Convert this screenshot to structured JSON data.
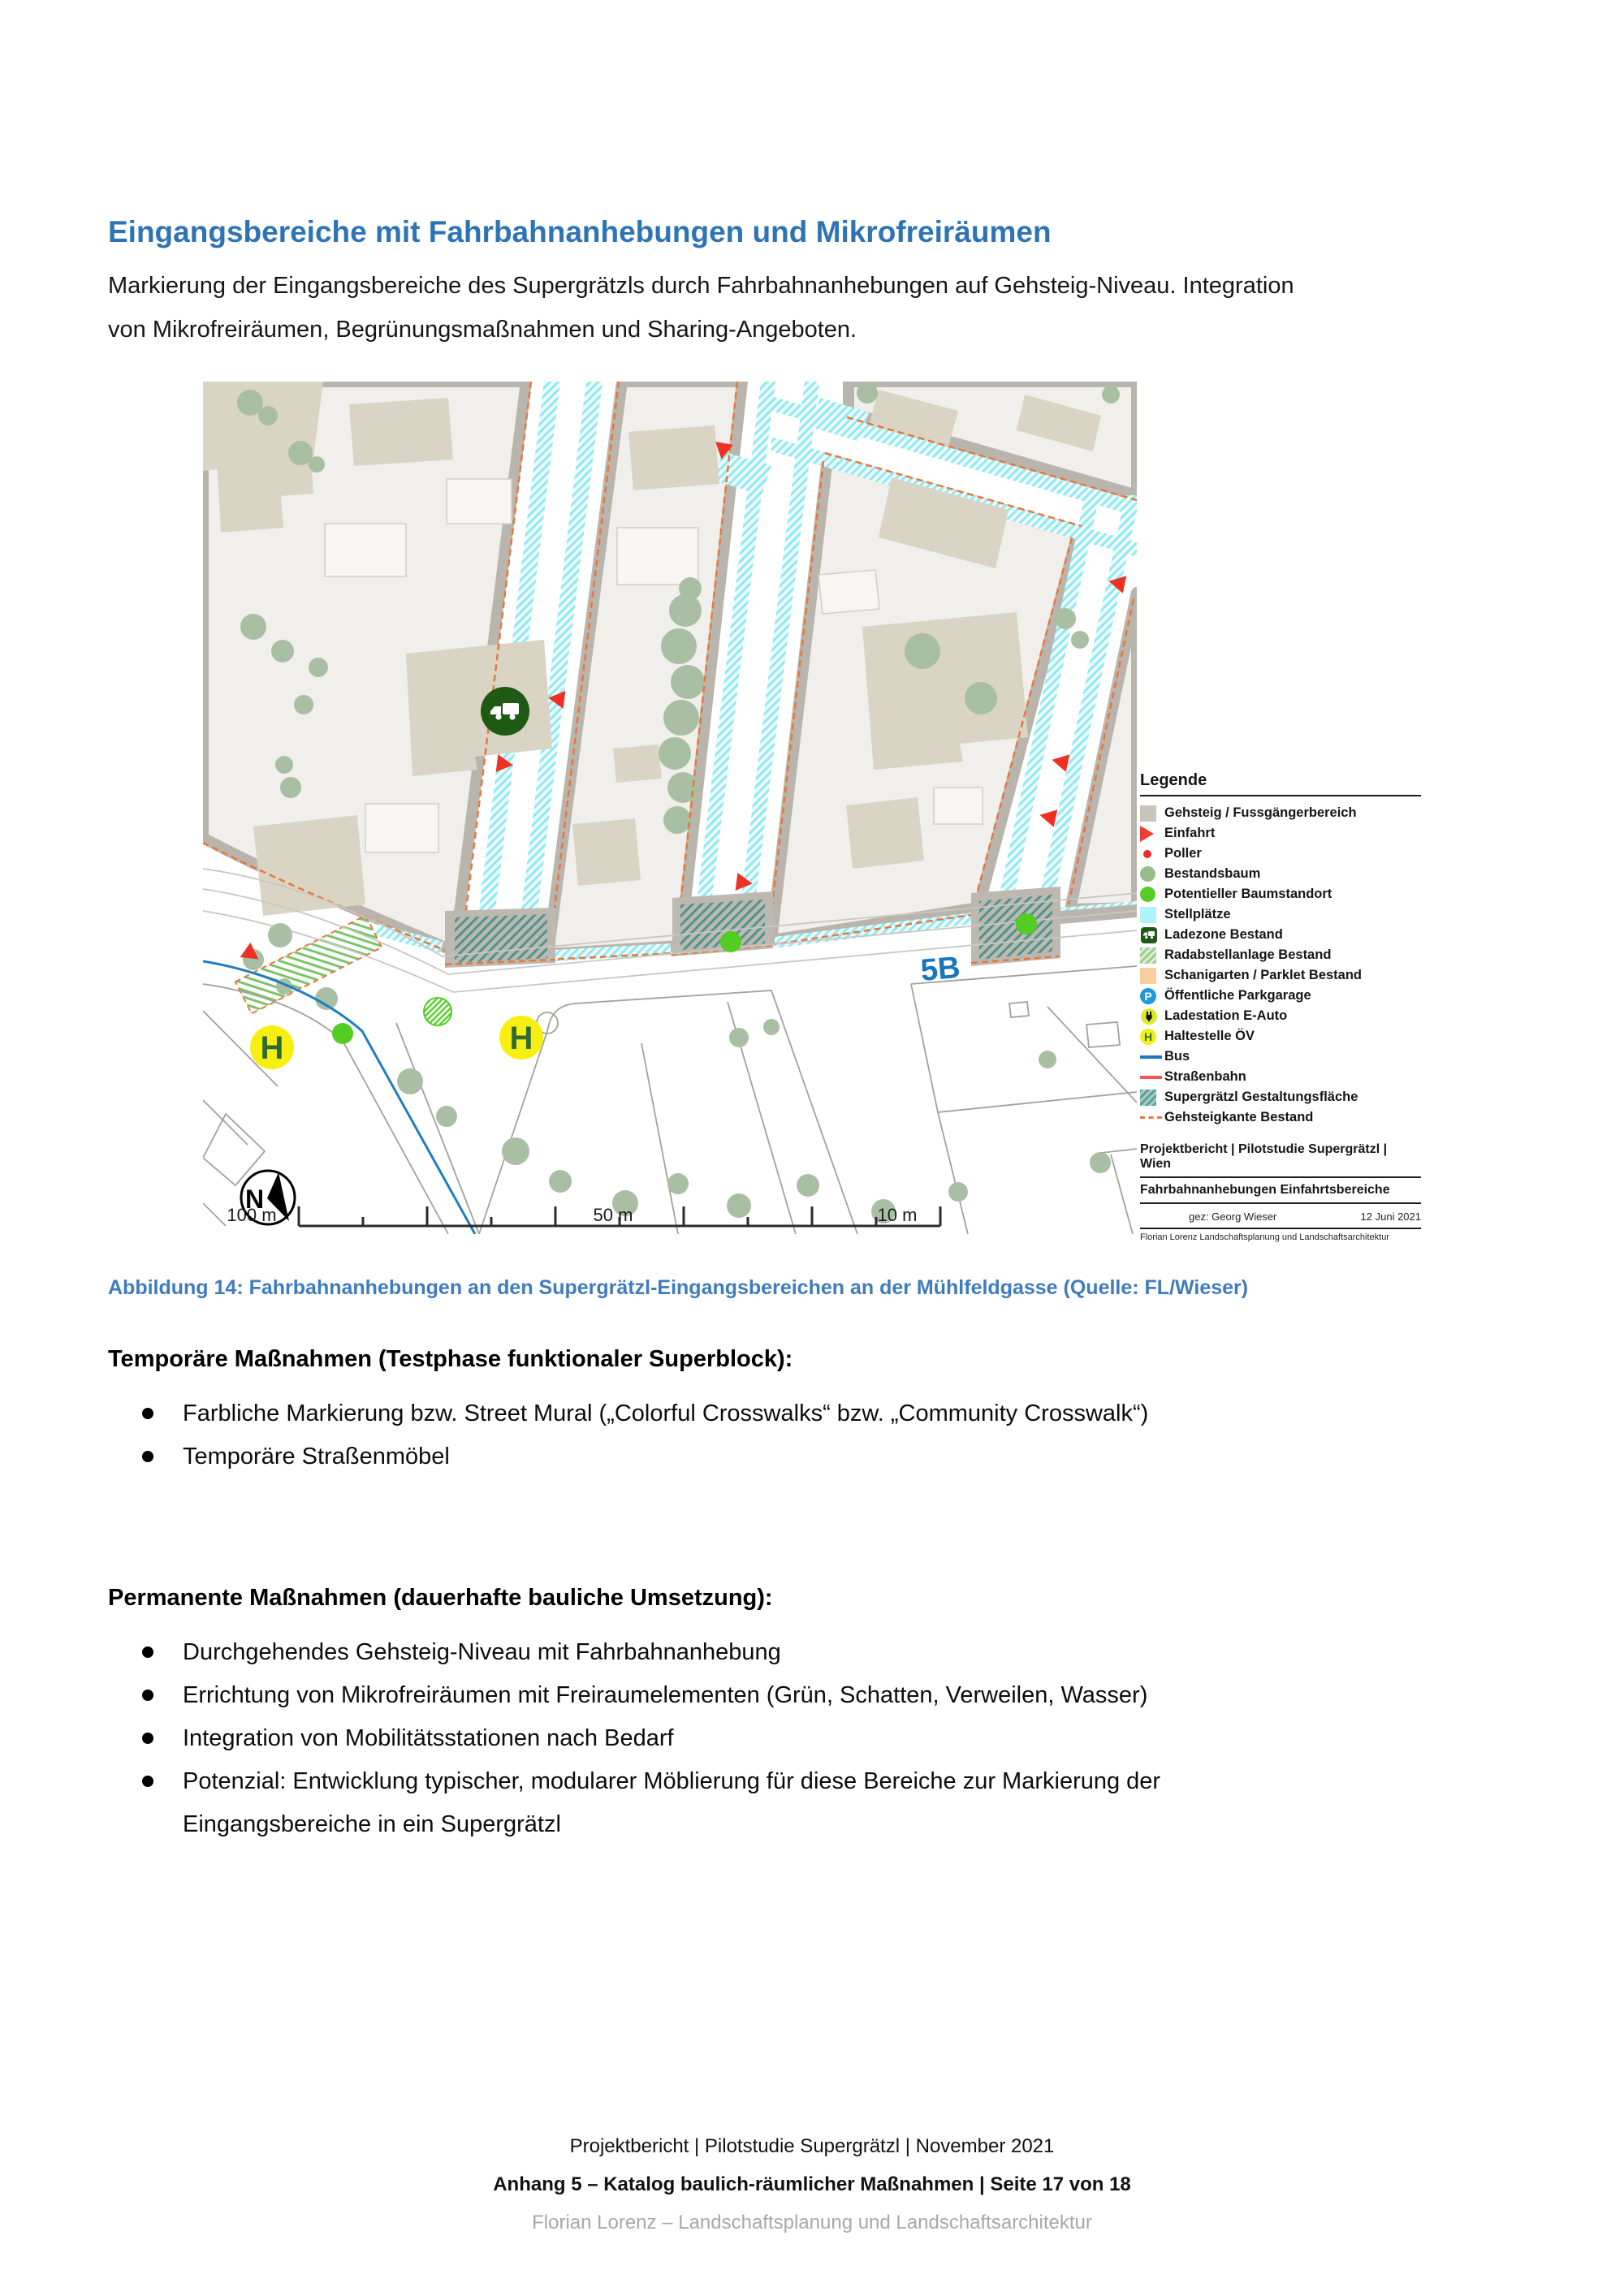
{
  "page": {
    "title": "Eingangsbereiche mit Fahrbahnanhebungen und Mikrofreiräumen",
    "subtitle": "Markierung der Eingangsbereiche des Supergrätzls durch Fahrbahnanhebungen auf Gehsteig-Niveau. Integration von Mikrofreiräumen, Begrünungsmaßnahmen und Sharing-Angeboten.",
    "caption": "Abbildung 14: Fahrbahnanhebungen an den Supergrätzl-Eingangsbereichen an der Mühlfeldgasse (Quelle: FL/Wieser)"
  },
  "sections": [
    {
      "heading": "Temporäre Maßnahmen (Testphase funktionaler Superblock):",
      "bullets": [
        "Farbliche Markierung bzw. Street Mural („Colorful Crosswalks“ bzw. „Community Crosswalk“)",
        "Temporäre Straßenmöbel"
      ]
    },
    {
      "heading": "Permanente Maßnahmen (dauerhafte bauliche Umsetzung):",
      "bullets": [
        "Durchgehendes Gehsteig-Niveau mit Fahrbahnanhebung",
        "Errichtung von Mikrofreiräumen mit Freiraumelementen (Grün, Schatten, Verweilen, Wasser)",
        "Integration von Mobilitätsstationen nach Bedarf",
        "Potenzial: Entwicklung typischer, modularer Möblierung für diese Bereiche zur Markierung der Eingangsbereiche in ein Supergrätzl"
      ]
    }
  ],
  "map_labels": {
    "route": "5B",
    "stop": "H",
    "north": "N",
    "scale": [
      "100 m",
      "50 m",
      "10 m"
    ]
  },
  "legend": {
    "title": "Legende",
    "items": [
      {
        "name": "gehsteig",
        "icon": "square",
        "color": "#C9C5BD",
        "label": "Gehsteig / Fussgängerbereich"
      },
      {
        "name": "einfahrt",
        "icon": "triangle",
        "color": "#F23B30",
        "label": "Einfahrt"
      },
      {
        "name": "poller",
        "icon": "dot",
        "color": "#E23128",
        "label": "Poller"
      },
      {
        "name": "bestandsbaum",
        "icon": "circle",
        "color": "#96BE8C",
        "label": "Bestandsbaum"
      },
      {
        "name": "potentieller-baumstandort",
        "icon": "circle",
        "color": "#55CD26",
        "label": "Potentieller Baumstandort"
      },
      {
        "name": "stellplaetze",
        "icon": "square",
        "color": "#AFF3F8",
        "label": "Stellplätze"
      },
      {
        "name": "ladezone",
        "icon": "truck-badge",
        "color": "#1E5A14",
        "label": "Ladezone Bestand"
      },
      {
        "name": "radabstellanlage",
        "icon": "hatch-green",
        "color": "#9CCE90",
        "label": "Radabstellanlage Bestand"
      },
      {
        "name": "schanigarten",
        "icon": "square",
        "color": "#F8CFA0",
        "label": "Schanigarten / Parklet Bestand"
      },
      {
        "name": "parkgarage",
        "icon": "circle-letter",
        "color": "#1D9BD8",
        "letter": "P",
        "letter_color": "#FFFFFF",
        "label": "Öffentliche Parkgarage"
      },
      {
        "name": "ladestation-e-auto",
        "icon": "plug-badge",
        "color": "#DDE72B",
        "label": "Ladestation E-Auto"
      },
      {
        "name": "haltestelle-oev",
        "icon": "circle-letter",
        "color": "#F2EE19",
        "letter": "H",
        "letter_color": "#2E6B34",
        "label": "Haltestelle ÖV"
      },
      {
        "name": "bus",
        "icon": "line",
        "color": "#1C77C0",
        "label": "Bus"
      },
      {
        "name": "strassenbahn",
        "icon": "line",
        "color": "#F0555A",
        "label": "Straßenbahn"
      },
      {
        "name": "supergraetzl-flaeche",
        "icon": "hatch-teal",
        "color": "#5FA09A",
        "label": "Supergrätzl Gestaltungsfläche"
      },
      {
        "name": "gehsteigkante",
        "icon": "dash-line",
        "color": "#E8773B",
        "label": "Gehsteigkante Bestand"
      }
    ],
    "block": {
      "line1": "Projektbericht | Pilotstudie Supergrätzl | Wien",
      "line2": "Fahrbahnanhebungen Einfahrtsbereiche",
      "signed": "gez: Georg Wieser",
      "date": "12 Juni 2021",
      "firm": "Florian Lorenz Landschaftsplanung und Landschaftsarchitektur"
    }
  },
  "footer": {
    "line1": "Projektbericht | Pilotstudie Supergrätzl | November 2021",
    "line2": "Anhang 5 – Katalog baulich-räumlicher Maßnahmen | Seite 17 von 18",
    "line3": "Florian Lorenz – Landschaftsplanung und Landschaftsarchitektur"
  },
  "colors": {
    "accent_heading": "#2E74B5",
    "caption_blue": "#3E7CBE",
    "route_blue": "#1B75BC",
    "entry_red": "#EE3124",
    "stop_yellow": "#F8EF12",
    "loading_green": "#1E5A14",
    "tree_green": "#A8BFA3",
    "new_tree_green": "#53CD23",
    "sidewalk_gray": "#B9B5AC",
    "parking_cyan": "#8FE9F2",
    "curb_orange": "#E8773B"
  }
}
